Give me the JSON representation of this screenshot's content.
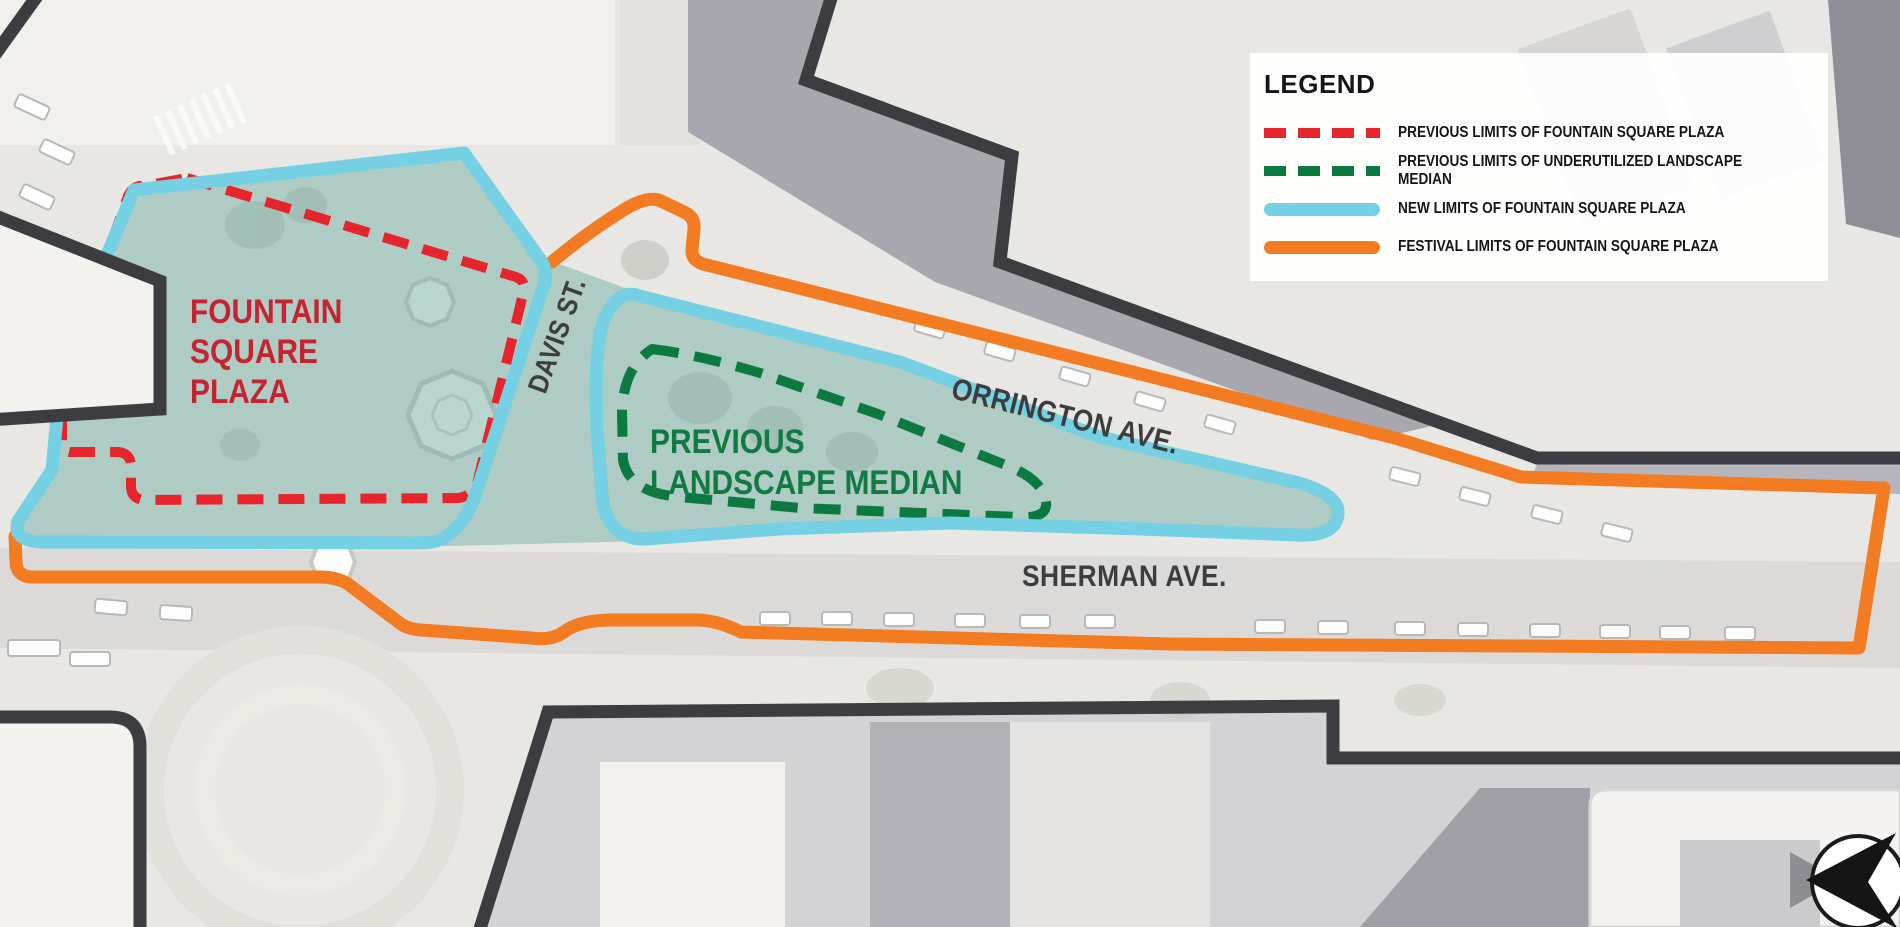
{
  "legend": {
    "title": "LEGEND",
    "items": [
      {
        "label": "PREVIOUS LIMITS OF FOUNTAIN SQUARE PLAZA",
        "swatch": "dashed",
        "color": "#e5242b"
      },
      {
        "label": "PREVIOUS LIMITS OF UNDERUTILIZED LANDSCAPE MEDIAN",
        "swatch": "dashed",
        "color": "#0c7940"
      },
      {
        "label": "NEW LIMITS OF FOUNTAIN SQUARE PLAZA",
        "swatch": "solid",
        "color": "#74d0e2"
      },
      {
        "label": "FESTIVAL LIMITS OF FOUNTAIN SQUARE PLAZA",
        "swatch": "solid",
        "color": "#f37b21"
      }
    ]
  },
  "map_labels": {
    "plaza": {
      "line1": "FOUNTAIN",
      "line2": "SQUARE",
      "line3": "PLAZA"
    },
    "median": {
      "line1": "PREVIOUS",
      "line2": "LANDSCAPE MEDIAN"
    },
    "davis_st": "DAVIS ST.",
    "orrington_ave": "ORRINGTON AVE.",
    "sherman_ave": "SHERMAN AVE."
  },
  "icons": {
    "north_arrow": "compass-north-arrow"
  },
  "colors": {
    "previous_plaza_limits": "#e5242b",
    "previous_median_limits": "#0c7940",
    "new_plaza_limits": "#74d0e2",
    "festival_limits": "#f37b21",
    "new_plaza_fill": "rgba(116,176,166,0.5)",
    "building_outline": "#3d3c40",
    "plaza_text": "#c4232f",
    "median_text": "#107a42",
    "street_text": "#3e3d3d",
    "legend_background": "rgba(255,255,255,0.93)"
  }
}
